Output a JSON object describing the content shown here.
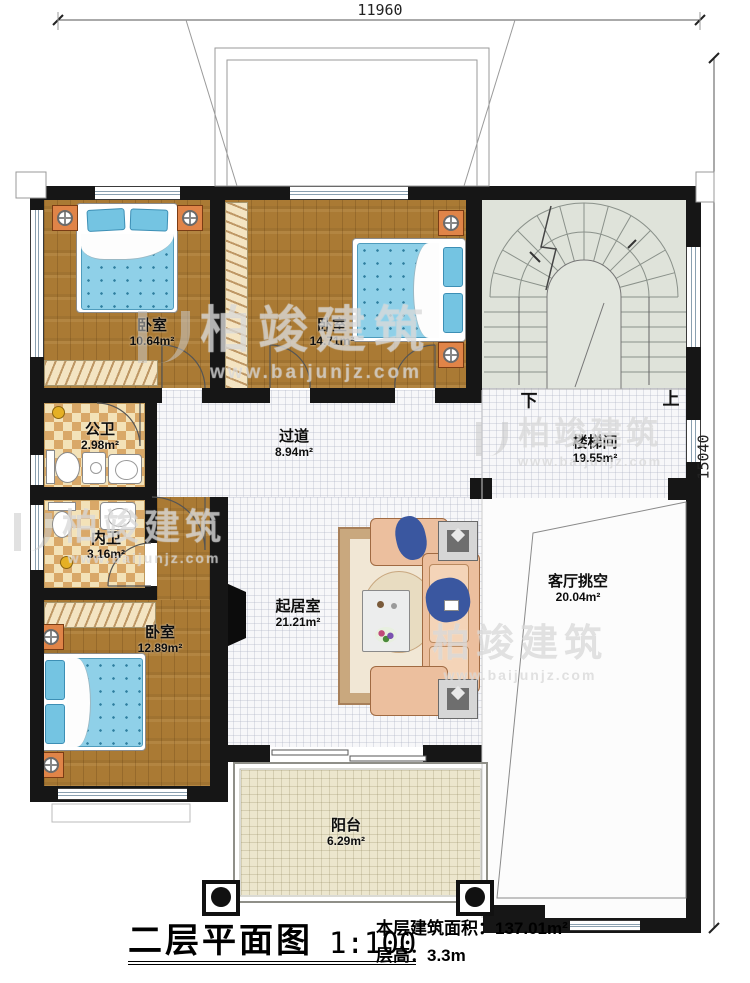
{
  "dimensions": {
    "top_width": "11960",
    "right_height": "15040"
  },
  "rooms": [
    {
      "id": "bedroom-1",
      "name": "卧室",
      "area": "10.64m²"
    },
    {
      "id": "bedroom-2",
      "name": "卧室",
      "area": "14.71m²"
    },
    {
      "id": "stairwell",
      "name": "楼梯间",
      "area": "19.55m²"
    },
    {
      "id": "public-bath",
      "name": "公卫",
      "area": "2.98m²"
    },
    {
      "id": "inner-bath",
      "name": "内卫",
      "area": "3.16m²"
    },
    {
      "id": "hallway",
      "name": "过道",
      "area": "8.94m²"
    },
    {
      "id": "living-room",
      "name": "起居室",
      "area": "21.21m²"
    },
    {
      "id": "living-void",
      "name": "客厅挑空",
      "area": "20.04m²"
    },
    {
      "id": "bedroom-3",
      "name": "卧室",
      "area": "12.89m²"
    },
    {
      "id": "balcony",
      "name": "阳台",
      "area": "6.29m²"
    }
  ],
  "stairs": {
    "down": "下",
    "up": "上"
  },
  "title_block": {
    "plan_title": "二层平面图",
    "scale": "1:100",
    "floor_area_label": "本层建筑面积：",
    "floor_area_value": "137.01m²",
    "floor_height_label": "层高：",
    "floor_height_value": "3.3m"
  },
  "watermark": {
    "brand": "柏竣建筑",
    "url": "www.baijunjz.com"
  },
  "colors": {
    "wall": "#161616",
    "wood_floor": "#aa7a34",
    "bath_tile": "#d9a868",
    "stair_floor": "#dfe3da",
    "balcony_floor": "#ece6cd",
    "mattress_blue": "#8fd0e8",
    "sofa_salmon": "#ecbf9e",
    "rug_border": "#c9a87e",
    "nightstand_orange": "#e08448"
  }
}
